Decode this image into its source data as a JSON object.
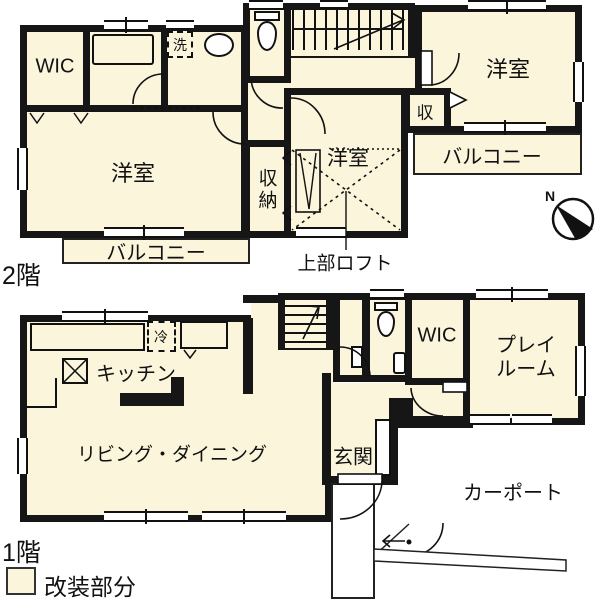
{
  "colors": {
    "room_fill": "#FAF5DB",
    "wall": "#161616"
  },
  "floor2": {
    "floor_label": "2階",
    "wic": "WIC",
    "laundry": "洗",
    "bedroom_left": "洋室",
    "bedroom_middle": "洋室",
    "bedroom_right": "洋室",
    "closet": "収納",
    "closet_small": "収",
    "balcony_left": "バルコニー",
    "balcony_right": "バルコニー",
    "loft_note": "上部ロフト"
  },
  "floor1": {
    "floor_label": "1階",
    "kitchen": "キッチン",
    "fridge": "冷",
    "living_dining": "リビング・ダイニング",
    "entrance": "玄関",
    "wic": "WIC",
    "playroom_line1": "プレイ",
    "playroom_line2": "ルーム",
    "carport": "カーポート"
  },
  "legend": {
    "label": "改装部分"
  },
  "compass": {
    "label": "N"
  }
}
